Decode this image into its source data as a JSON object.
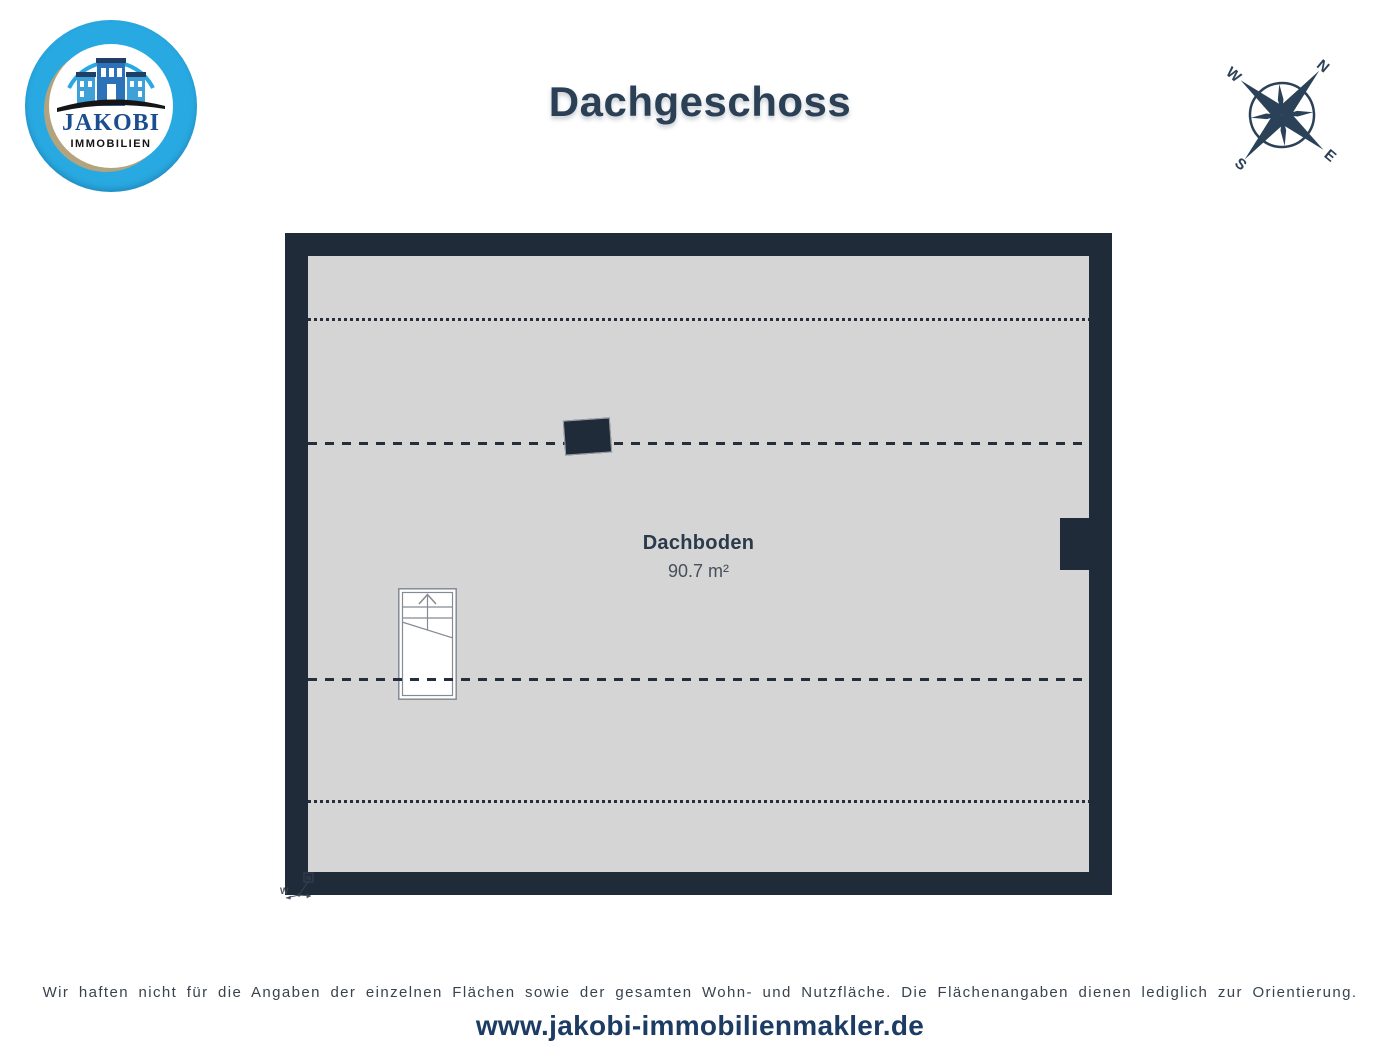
{
  "header": {
    "title": "Dachgeschoss",
    "logo": {
      "name": "JAKOBI",
      "subtitle": "IMMOBILIEN"
    },
    "compass": {
      "north": "N",
      "east": "E",
      "south": "S",
      "west": "W",
      "rotation_deg": 40
    }
  },
  "floorplan": {
    "room": {
      "name": "Dachboden",
      "area": "90.7 m²"
    },
    "mini_compass": {
      "west": "W",
      "north": "N"
    }
  },
  "footer": {
    "disclaimer": "Wir haften nicht für die Angaben der einzelnen Flächen sowie der gesamten Wohn- und Nutzfläche. Die Flächenangaben dienen lediglich zur Orientierung.",
    "website": "www.jakobi-immobilienmakler.de"
  },
  "colors": {
    "wall": "#202b39",
    "floor": "#d5d5d5",
    "title_navy": "#2b4055",
    "logo_ring_blue": "#29a9e1",
    "logo_name_blue": "#1a4e8f",
    "website_blue": "#1c3c63"
  }
}
